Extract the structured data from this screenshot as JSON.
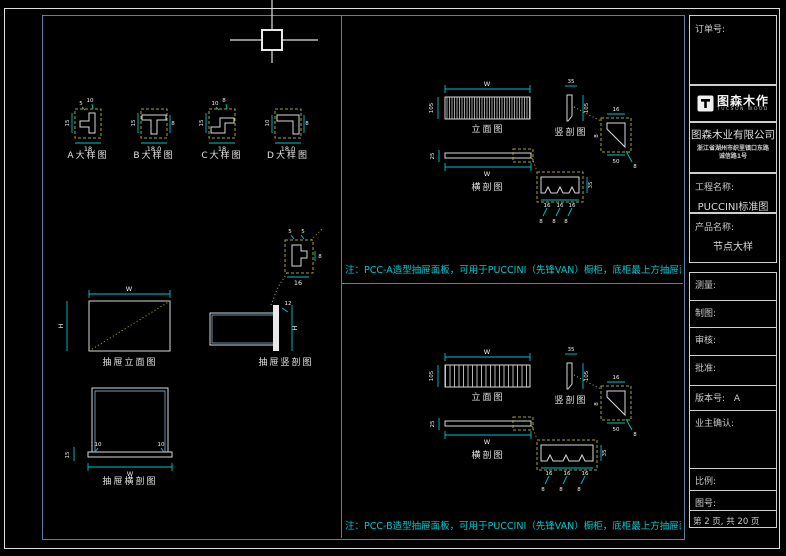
{
  "colors": {
    "frame_white": "#dcdcdc",
    "frame_blue": "#5d7ea3",
    "dim_cyan": "#00c4ce",
    "dash_yellow": "#a3a326",
    "note_cyan": "#00c6cc",
    "line_white": "#d9d9d9"
  },
  "title_block": {
    "order_label": "订单号:",
    "logo": {
      "brand": "图森木作",
      "sub": "TUCSON WOOD"
    },
    "company": "图森木业有限公司",
    "address_line1": "浙江省湖州市织里镇口东路",
    "address_line2": "诚信路1号",
    "project_label": "工程名称:",
    "project_value": "PUCCINI标准图",
    "product_label": "产品名称:",
    "product_value": "节点大样",
    "rows": {
      "measure": "测量:",
      "draft": "制图:",
      "review": "审核:",
      "approve": "批准:",
      "version_label": "版本号:",
      "version_value": "A",
      "owner_confirm": "业主确认:",
      "scale_label": "比例:",
      "drawing_no_label": "图号:",
      "page_text": "第 2 页, 共 20 页"
    }
  },
  "details": [
    {
      "label": "A大样图",
      "dims": {
        "top1": "5",
        "top2": "10",
        "left": "15",
        "bottom": "18",
        "right": ""
      }
    },
    {
      "label": "B大样图",
      "dims": {
        "top1": "",
        "top2": "",
        "left": "15",
        "bottom": "18.0",
        "right": "8"
      }
    },
    {
      "label": "C大样图",
      "dims": {
        "top1": "10",
        "top2": "8",
        "left": "15",
        "bottom": "18",
        "right": ""
      }
    },
    {
      "label": "D大样图",
      "dims": {
        "top1": "",
        "top2": "",
        "left": "10",
        "bottom": "18.0",
        "right": "8"
      }
    }
  ],
  "drawer": {
    "elevation": {
      "label": "抽屉立面图",
      "dim_top": "W",
      "dim_left": "H"
    },
    "vsection": {
      "label": "抽屉竖剖图",
      "dim_top": "12",
      "dim_right": "H"
    },
    "callout": {
      "dim_top1": "5",
      "dim_top2": "5",
      "dim_right": "8",
      "dim_bottom": "16"
    },
    "hsection": {
      "label": "抽屉横剖图",
      "dim_inner_left": "10",
      "dim_inner_right": "10",
      "dim_left": "15",
      "dim_bottom": "W"
    }
  },
  "sections": [
    {
      "note": "注：PCC-A造型抽屉面板，可用于PUCCINI（先锋VAN）橱柜，底柜最上方抽屉面板.",
      "elevation_label": "立面图",
      "hsection_label": "横剖图",
      "vsection_label": "竖剖图",
      "dims": {
        "elev_w": "W",
        "elev_h": "105",
        "hsec_w": "W",
        "hsec_t": "25",
        "vsec_top": "35",
        "vsec_side": "105",
        "wedge_top": "16",
        "wedge_left": "8",
        "wedge_bottom": "50",
        "wedge_leader": "8",
        "notch_right": "35",
        "notch_b1": "16",
        "notch_b2": "16",
        "notch_b3": "16",
        "notch_l1": "8",
        "notch_l2": "8",
        "notch_l3": "8"
      }
    },
    {
      "note": "注：PCC-B造型抽屉面板，可用于PUCCINI（先锋VAN）橱柜，底柜最上方抽屉面板.",
      "elevation_label": "立面图",
      "hsection_label": "横剖图",
      "vsection_label": "竖剖图",
      "dims": {
        "elev_w": "W",
        "elev_h": "105",
        "hsec_w": "W",
        "hsec_t": "25",
        "vsec_top": "35",
        "vsec_side": "105",
        "wedge_top": "16",
        "wedge_left": "8",
        "wedge_bottom": "50",
        "wedge_leader": "8",
        "notch_right": "35",
        "notch_b1": "16",
        "notch_b2": "16",
        "notch_b3": "16",
        "notch_l1": "8",
        "notch_l2": "8",
        "notch_l3": "8"
      }
    }
  ]
}
